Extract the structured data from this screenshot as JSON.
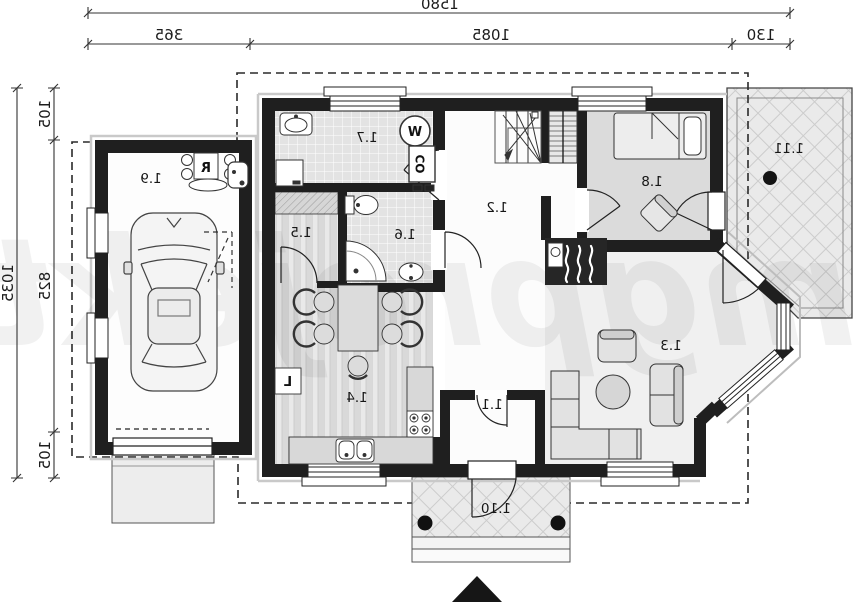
{
  "dimensions_top": {
    "total": "1580",
    "segments": [
      "365",
      "1085",
      "130"
    ]
  },
  "dimensions_left": {
    "total": "1035",
    "segments": [
      "105",
      "825",
      "105"
    ]
  },
  "rooms": {
    "vestibule": "1.1",
    "hall": "1.2",
    "living_room": "1.3",
    "kitchen_dining": "1.4",
    "pantry": "1.5",
    "bathroom": "1.6",
    "utility": "1.7",
    "bedroom": "1.8",
    "garage": "1.9",
    "porch": "1.10",
    "terrace": "1.11"
  },
  "appliances": {
    "washing_machine": "W",
    "boiler": "CO",
    "garage_heater": "R",
    "fridge": "L"
  },
  "watermark": "mgprojekt"
}
